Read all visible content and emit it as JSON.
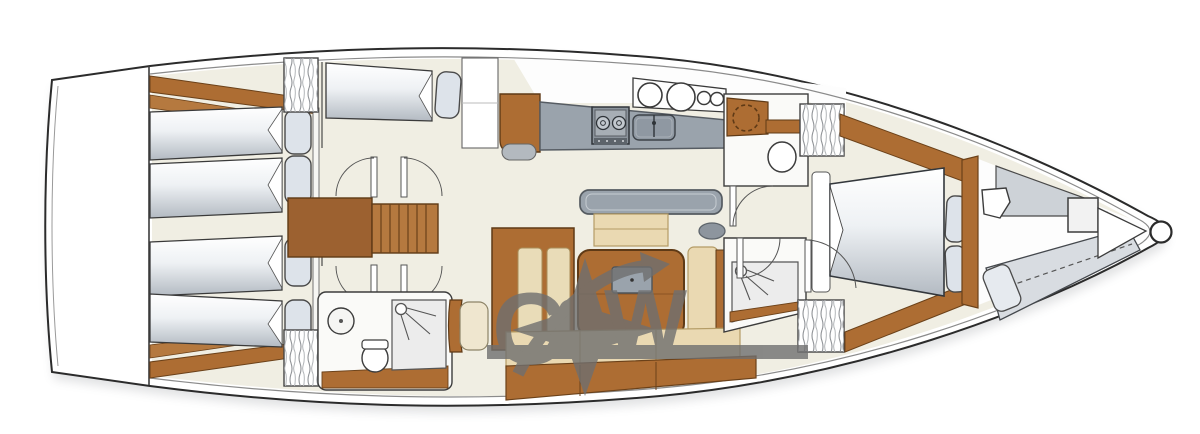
{
  "diagram": {
    "description": "sailing-yacht interior deck plan, bow pointing right",
    "orientation": "bow-right",
    "watermark": {
      "c": "C",
      "amp": "&",
      "w": "W"
    },
    "colors": {
      "hull_outline": "#2b2b2b",
      "floor_cream": "#f0eee3",
      "wood": "#ad6d33",
      "wood_dark": "#5f3a16",
      "counter_gray": "#9aa3ac",
      "cushion_beige": "#ead9b2",
      "mattress_gray": "#b3bac2",
      "pillow_gray": "#dde3ea",
      "watermark_gray": "#6f6f6f"
    },
    "areas": [
      {
        "name": "swim-platform"
      },
      {
        "name": "aft-cabin-port",
        "berths": 2
      },
      {
        "name": "aft-cabin-starboard",
        "berths": 2
      },
      {
        "name": "skipper-berth-port",
        "berths": 1
      },
      {
        "name": "companionway-stairs"
      },
      {
        "name": "aft-head",
        "features": [
          "washbasin",
          "toilet",
          "shower"
        ]
      },
      {
        "name": "nav-seat"
      },
      {
        "name": "galley",
        "features": [
          "fridge-cabinet",
          "stove-2-burner",
          "double-sink",
          "porthole-circles-4"
        ]
      },
      {
        "name": "saloon",
        "features": [
          "sofa-bench",
          "ottoman",
          "dining-table",
          "folding-leaf",
          "side-settee",
          "long-settee",
          "sideboard"
        ]
      },
      {
        "name": "forward-head-port",
        "features": [
          "vanity-basin",
          "toilet"
        ]
      },
      {
        "name": "forward-shower-starboard"
      },
      {
        "name": "master-cabin",
        "features": [
          "island-double-bed",
          "two-pillows",
          "wardrobes"
        ]
      },
      {
        "name": "forepeak",
        "features": [
          "crew-berth",
          "crew-toilet",
          "windlass-box",
          "anchor-locker",
          "bow-roller"
        ]
      }
    ]
  }
}
